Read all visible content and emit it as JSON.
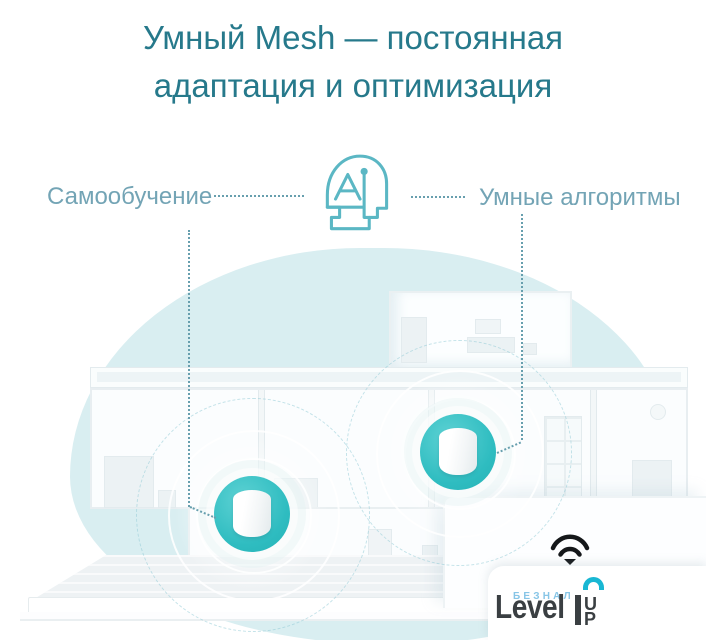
{
  "title": {
    "line1": "Умный Mesh — постоянная",
    "line2": "адаптация и оптимизация"
  },
  "callouts": {
    "left_label": "Самообучение",
    "right_label": "Умные алгоритмы"
  },
  "icons": {
    "ai_head": "ai-head-icon",
    "wifi": "wifi-signal-down-icon"
  },
  "scene": {
    "type": "house-cutaway-illustration",
    "mesh_units": 2
  },
  "logo": {
    "pre": "БЕЗНАЛ",
    "main": "Level",
    "up_first": "U",
    "up_second": "P"
  },
  "colors": {
    "title": "#26798b",
    "label": "#73a4b5",
    "dotted_line": "#679fae",
    "ai_stroke": "#5bb7c4",
    "blob": "#d9eef1",
    "accent_teal": "#2ebcc0",
    "logo_dark": "#3a3f42",
    "logo_blue": "#87c5e6",
    "logo_teal": "#18b7d3",
    "wifi_icon": "#15181a"
  }
}
